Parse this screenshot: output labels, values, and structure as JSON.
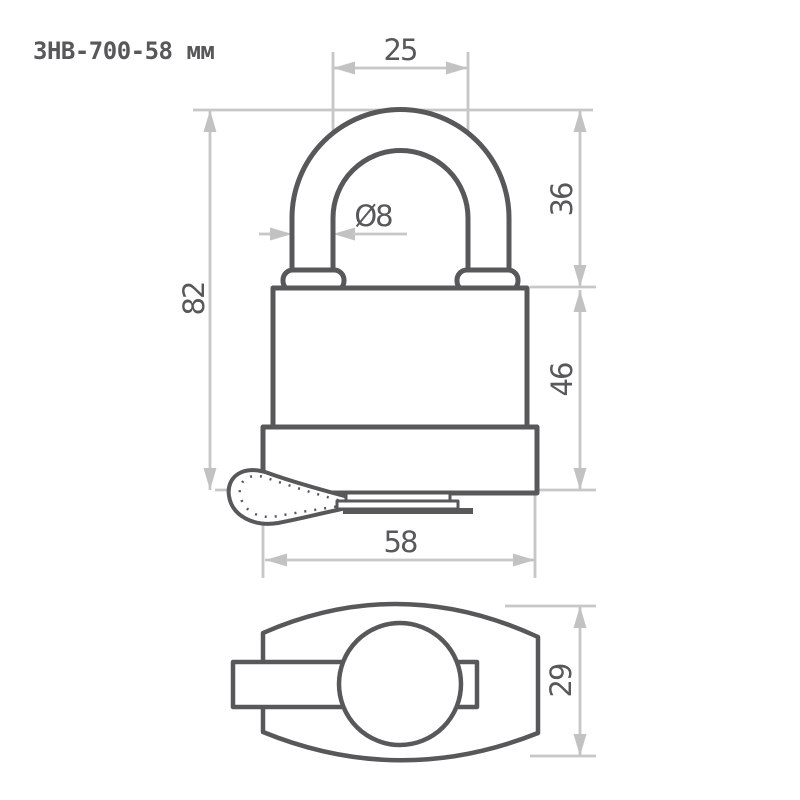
{
  "title": "ЗНВ-700-58 мм",
  "colors": {
    "outline": "#58585a",
    "dim_line": "#c7c7c7",
    "dim_arrow": "#c2c2c2",
    "text": "#58585a",
    "background": "#ffffff"
  },
  "front_view": {
    "dims": {
      "shackle_inner_width": "25",
      "shackle_rod_diameter": "Ø8",
      "shackle_height": "36",
      "overall_height": "82",
      "body_height": "46",
      "body_width": "58"
    }
  },
  "bottom_view": {
    "dims": {
      "body_depth": "29"
    }
  }
}
